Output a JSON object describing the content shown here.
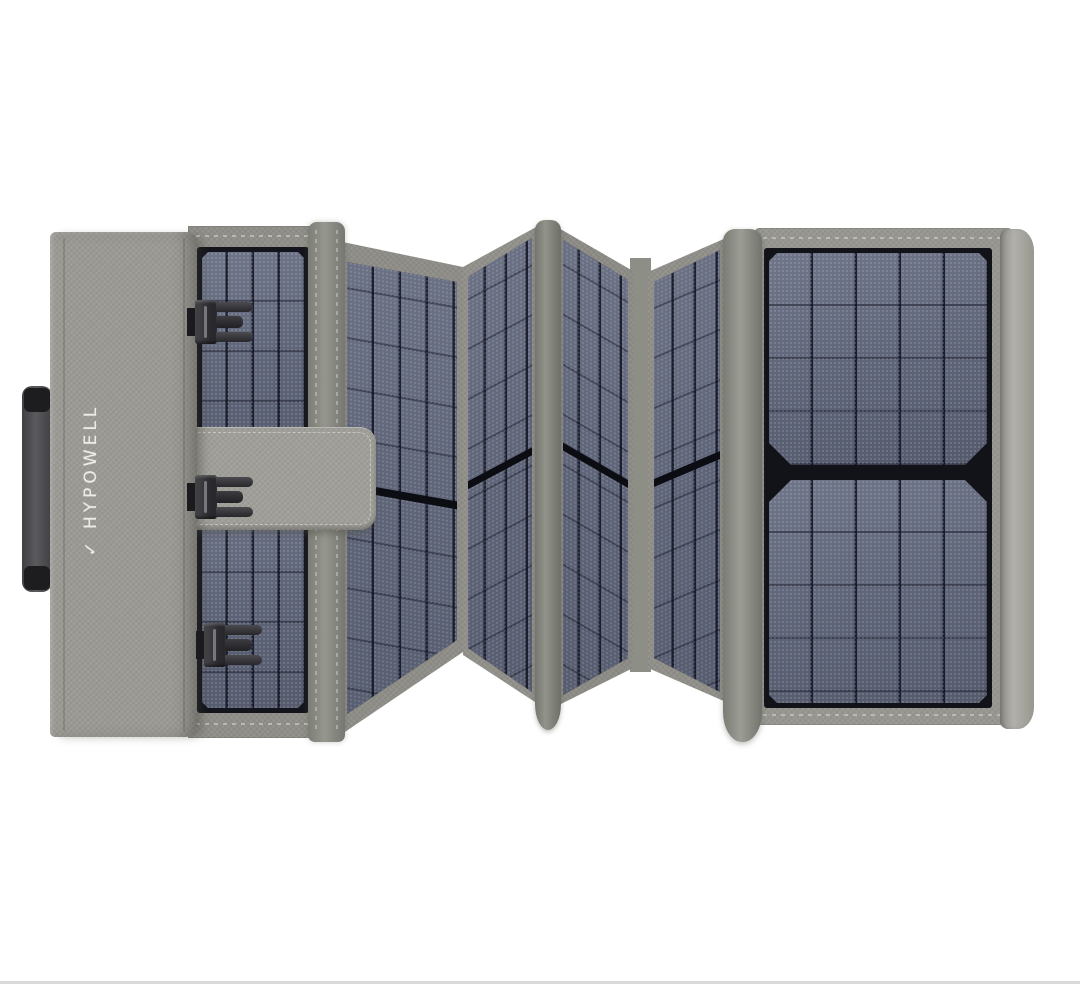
{
  "image": {
    "kind": "product-photo",
    "background_color": "#ffffff",
    "bottom_edge_line_color": "#dadada",
    "alt": "Gray foldable portable solar panel charger shown accordion-folded on a white background"
  },
  "product": {
    "brand": "HYPOWELL",
    "brand_mark": "✓",
    "logo_text_color": "#ecebe7",
    "visible_solar_sections": 6,
    "buckle_count": 3,
    "has_carry_handle": true,
    "has_closure_strap": true
  },
  "palette": {
    "fabric_gray": "#9b9a94",
    "fabric_dark": "#8e8d87",
    "hinge_gray": "#87887f",
    "binding_gray": "#a9a8a2",
    "cell_slate": "#646a7e",
    "cell_grid": "#1f2232",
    "cell_frame": "#14151c",
    "buckle_black": "#2b2b2e",
    "handle_gray": "#4b4b4e"
  }
}
